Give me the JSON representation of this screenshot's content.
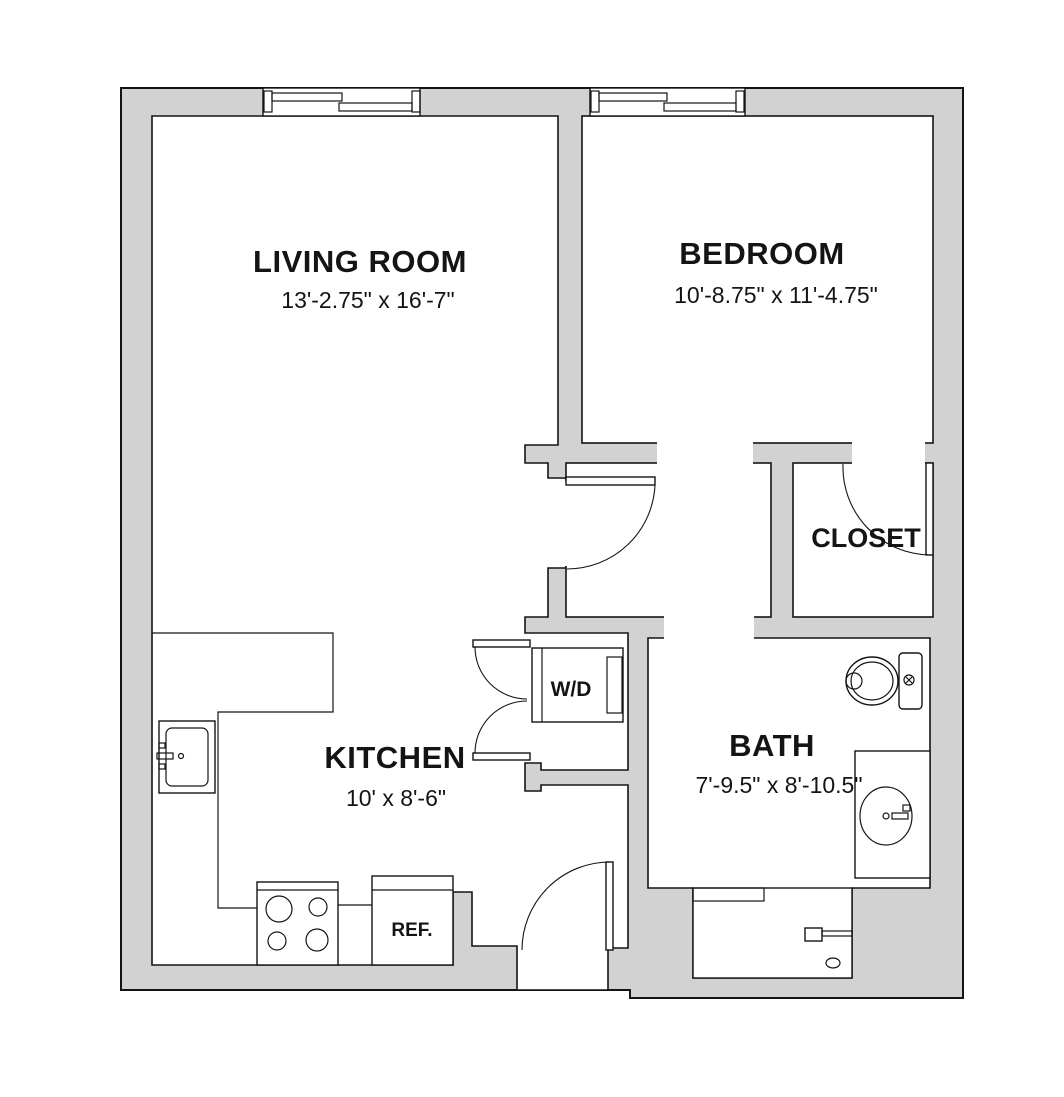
{
  "diagram_type": "apartment-floor-plan",
  "colors": {
    "wall_fill": "#d2d2d2",
    "line": "#141414",
    "floor": "#ffffff"
  },
  "rooms": [
    {
      "id": "living-room",
      "name": "LIVING ROOM",
      "dimensions": "13'-2.75\" x 16'-7\""
    },
    {
      "id": "bedroom",
      "name": "BEDROOM",
      "dimensions": "10'-8.75\" x 11'-4.75\""
    },
    {
      "id": "kitchen",
      "name": "KITCHEN",
      "dimensions": "10' x 8'-6\""
    },
    {
      "id": "bath",
      "name": "BATH",
      "dimensions": "7'-9.5\" x 8'-10.5\""
    },
    {
      "id": "closet",
      "name": "CLOSET",
      "dimensions": ""
    }
  ],
  "labels": {
    "washer_dryer": "W/D",
    "refrigerator": "REF."
  },
  "fixtures": [
    "living-room-window",
    "bedroom-window",
    "entry-door",
    "living-room-door",
    "closet-door",
    "bifold-laundry-doors",
    "kitchen-sink",
    "kitchen-counter",
    "range-stove",
    "refrigerator",
    "washer-dryer",
    "toilet",
    "vanity-sink",
    "bathtub"
  ]
}
